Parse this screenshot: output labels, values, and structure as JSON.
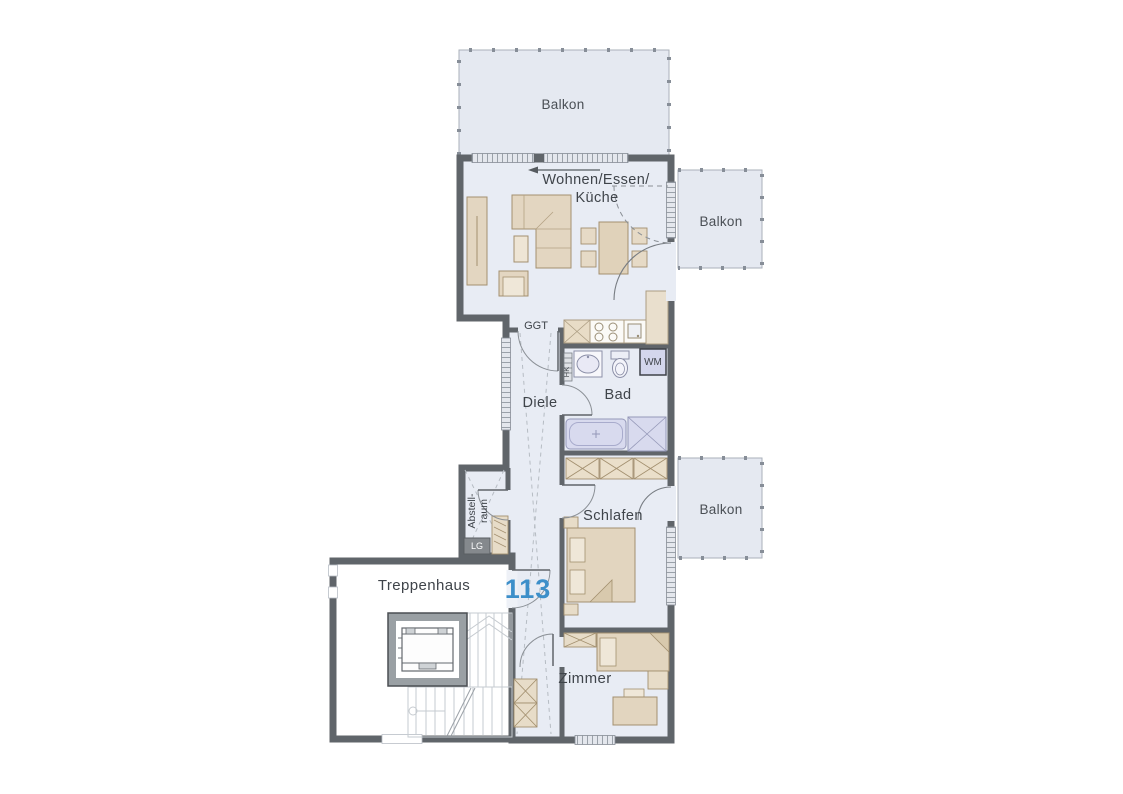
{
  "plan": {
    "rooms": {
      "balkon_top": {
        "label": "Balkon"
      },
      "balkon_mid": {
        "label": "Balkon"
      },
      "balkon_low": {
        "label": "Balkon"
      },
      "wohnen": {
        "line1": "Wohnen/Essen/",
        "line2": "Küche"
      },
      "diele": {
        "label": "Diele"
      },
      "bad": {
        "label": "Bad"
      },
      "abstellraum": {
        "line1": "Abstell-",
        "line2": "raum"
      },
      "schlafen": {
        "label": "Schlafen"
      },
      "treppenhaus": {
        "label": "Treppenhaus"
      },
      "zimmer": {
        "label": "Zimmer"
      }
    },
    "annotations": {
      "unit_number": "113",
      "door_code": "GGT",
      "washing_machine": "WM",
      "radiator": "HK",
      "vent_unit": "LG"
    },
    "colors": {
      "room_fill": "#e8ecf4",
      "balcony_fill": "#e5e9f1",
      "wall_gray": "#60656a",
      "furniture_beige": "#e3d6c1",
      "sanitary_lavender": "#d8daee",
      "unit_number_blue": "#3d8fc9",
      "label_text": "#3f444a"
    }
  }
}
